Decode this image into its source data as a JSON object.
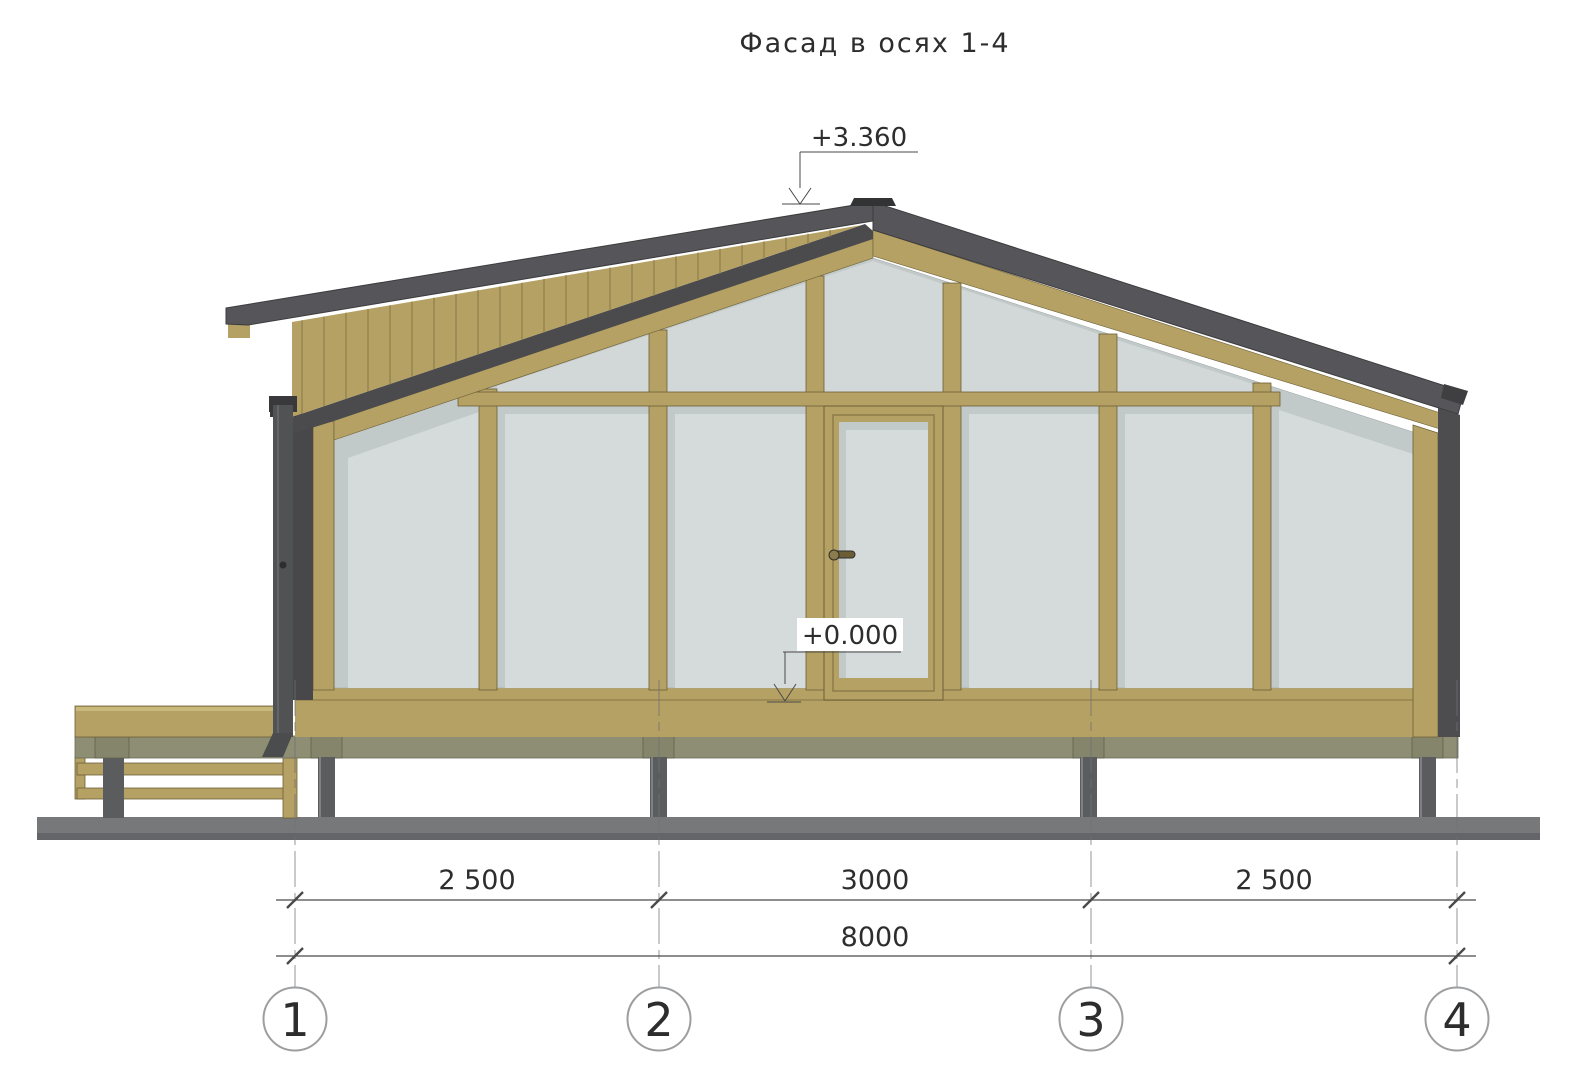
{
  "drawing": {
    "title": "Фасад в осях 1-4",
    "elevation_marks": [
      {
        "id": "ridge",
        "label": "+3.360"
      },
      {
        "id": "floor",
        "label": "+0.000"
      }
    ],
    "dimensions": {
      "segments": [
        {
          "from": "1",
          "to": "2",
          "label": "2 500"
        },
        {
          "from": "2",
          "to": "3",
          "label": "3000"
        },
        {
          "from": "3",
          "to": "4",
          "label": "2 500"
        }
      ],
      "total": {
        "from": "1",
        "to": "4",
        "label": "8000"
      }
    },
    "axes": [
      {
        "label": "1"
      },
      {
        "label": "2"
      },
      {
        "label": "3"
      },
      {
        "label": "4"
      }
    ]
  },
  "colors": {
    "ink": "#2d2d2d",
    "line": "#4a4a4a",
    "wood": "#b4a163",
    "wood_light": "#c9b97c",
    "wood_dark": "#6e6038",
    "siding_line": "#8f7e4c",
    "glass": "#d5dada",
    "glass_shadow": "#c2c9c9",
    "roof": "#56565a",
    "roof_dark": "#4b4b4e",
    "roof_darkest": "#39393c",
    "olive": "#8e8e74",
    "post": "#5a5c5e",
    "ground": "#76787a"
  }
}
